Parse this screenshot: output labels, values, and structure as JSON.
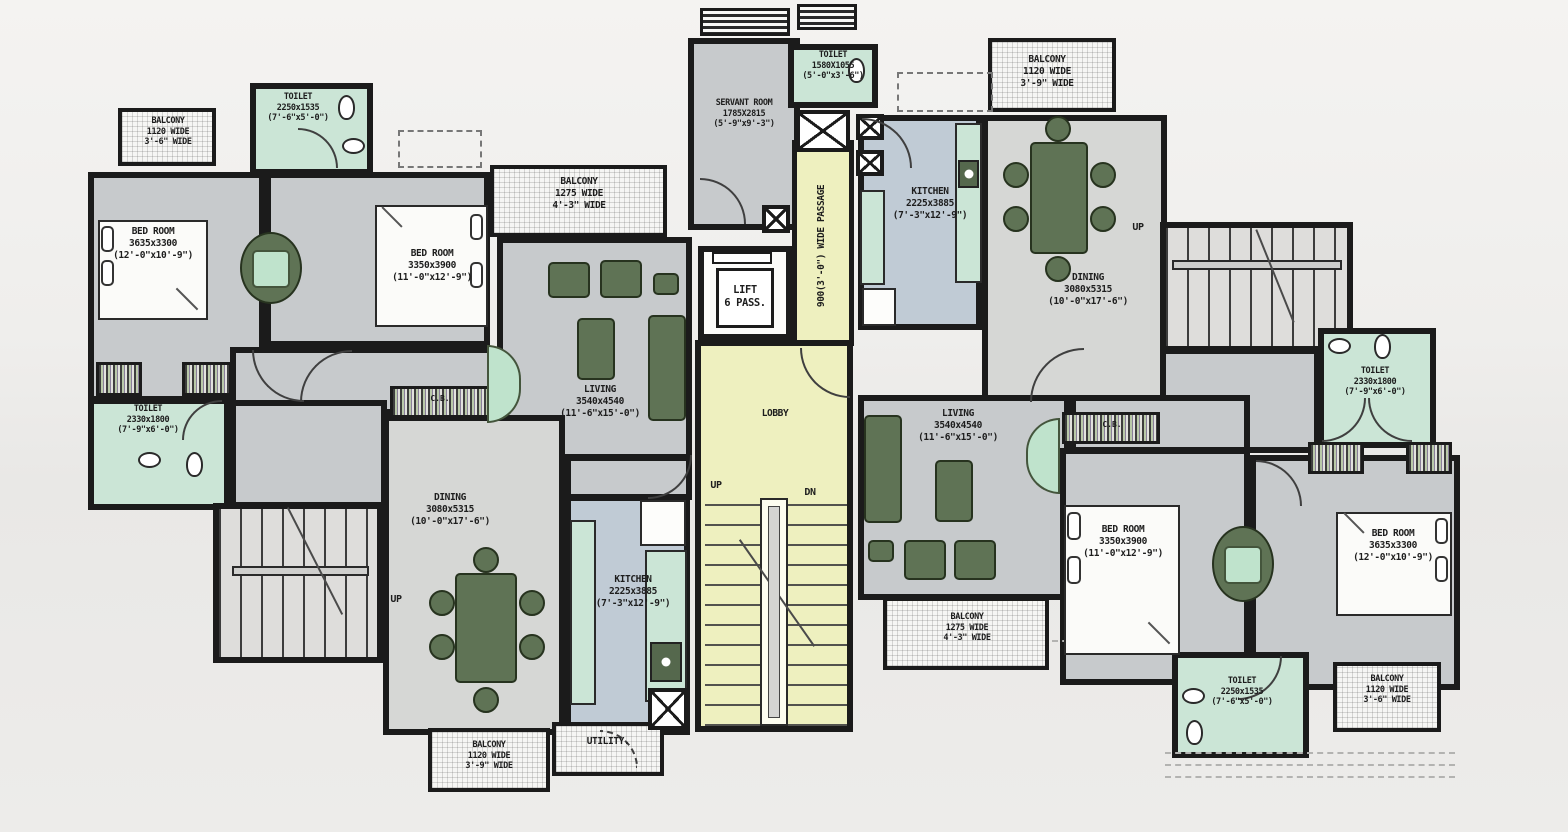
{
  "title": "Apartment typical floor plan",
  "rooms": {
    "balcony_tl": {
      "lines": [
        "BALCONY",
        "1120 WIDE",
        "3'-6\" WIDE"
      ]
    },
    "toilet_tl": {
      "lines": [
        "TOILET",
        "2250x1535",
        "(7'-6\"x5'-0\")"
      ]
    },
    "bedroom_tl": {
      "lines": [
        "BED ROOM",
        "3635x3300",
        "(12'-0\"x10'-9\")"
      ]
    },
    "bedroom_tl2": {
      "lines": [
        "BED ROOM",
        "3350x3900",
        "(11'-0\"x12'-9\")"
      ]
    },
    "balcony_left": {
      "lines": [
        "BALCONY",
        "1275 WIDE",
        "4'-3\" WIDE"
      ]
    },
    "living_left": {
      "lines": [
        "LIVING",
        "3540x4540",
        "(11'-6\"x15'-0\")"
      ]
    },
    "toilet_left": {
      "lines": [
        "TOILET",
        "2330x1800",
        "(7'-9\"x6'-0\")"
      ]
    },
    "dining_left": {
      "lines": [
        "DINING",
        "3080x5315",
        "(10'-0\"x17'-6\")"
      ]
    },
    "kitchen_left": {
      "lines": [
        "KITCHEN",
        "2225x3885",
        "(7'-3\"x12'-9\")"
      ]
    },
    "balcony_bl": {
      "lines": [
        "BALCONY",
        "1120 WIDE",
        "3'-9\" WIDE"
      ]
    },
    "utility": {
      "label": "UTILITY."
    },
    "servant_room": {
      "lines": [
        "SERVANT ROOM",
        "1785X2815",
        "(5'-9\"x9'-3\")"
      ]
    },
    "toilet_top": {
      "lines": [
        "TOILET",
        "1580X1055",
        "(5'-0\"x3'-6\")"
      ]
    },
    "lift": {
      "lines": [
        "LIFT",
        "6 PASS."
      ]
    },
    "lobby": {
      "label": "LOBBY"
    },
    "passage": {
      "label": "900(3'-0\") WIDE PASSAGE"
    },
    "kitchen_right": {
      "lines": [
        "KITCHEN",
        "2225x3885",
        "(7'-3\"x12'-9\")"
      ]
    },
    "balcony_tr": {
      "lines": [
        "BALCONY",
        "1120 WIDE",
        "3'-9\" WIDE"
      ]
    },
    "dining_right": {
      "lines": [
        "DINING",
        "3080x5315",
        "(10'-0\"x17'-6\")"
      ]
    },
    "toilet_right": {
      "lines": [
        "TOILET",
        "2330x1800",
        "(7'-9\"x6'-0\")"
      ]
    },
    "living_right": {
      "lines": [
        "LIVING",
        "3540x4540",
        "(11'-6\"x15'-0\")"
      ]
    },
    "balcony_right": {
      "lines": [
        "BALCONY",
        "1275 WIDE",
        "4'-3\" WIDE"
      ]
    },
    "bedroom_right": {
      "lines": [
        "BED ROOM",
        "3350x3900",
        "(11'-0\"x12'-9\")"
      ]
    },
    "bedroom_far_right": {
      "lines": [
        "BED ROOM",
        "3635x3300",
        "(12'-0\"x10'-9\")"
      ]
    },
    "toilet_br": {
      "lines": [
        "TOILET",
        "2250x1535",
        "(7'-6\"x5'-0\")"
      ]
    },
    "balcony_br": {
      "lines": [
        "BALCONY",
        "1120 WIDE",
        "3'-6\" WIDE"
      ]
    }
  },
  "stairs": {
    "up_label": "UP",
    "down_label": "DN"
  },
  "wardrobe_label": "C.B.",
  "colors": {
    "wall": "#1b1b1b",
    "floor": "#c7cacc",
    "floor_light": "#d6d7d5",
    "toilet_green": "#cbe5d6",
    "kitchen_floor": "#c0cbd5",
    "lobby_yellow": "#eef0bf",
    "furniture_green": "#5f7355",
    "furniture_mint": "#bfe3cc",
    "paper": "#f0efed"
  }
}
